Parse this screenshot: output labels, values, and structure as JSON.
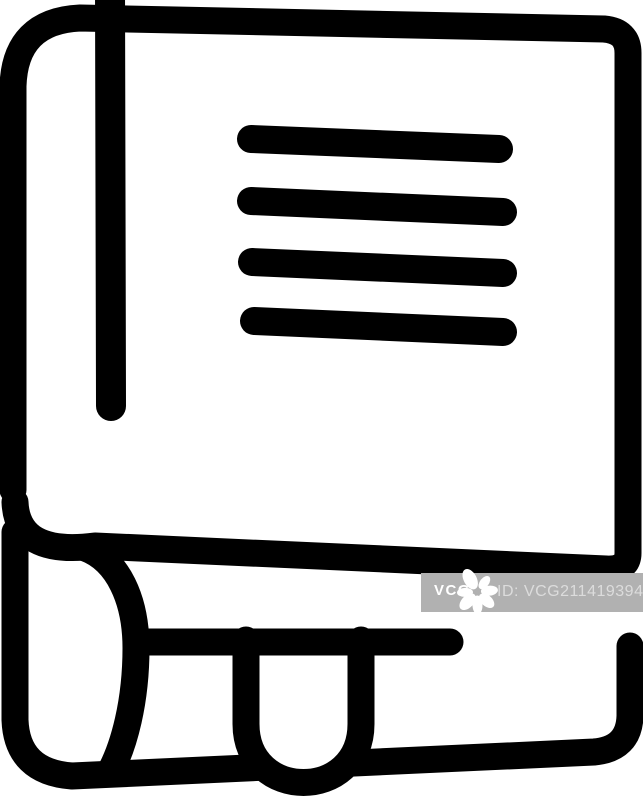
{
  "canvas": {
    "background_color": "#ffffff",
    "width": 643,
    "height": 800
  },
  "icon": {
    "name": "book-with-bookmark-line-icon",
    "description": "Black outline book: tilted cover, spine line, four text lines, rolled page with hanging bookmark",
    "color": "#000000"
  },
  "watermark": {
    "brand": "VCG",
    "id_label": "ID: VCG211419394340",
    "logo_icon": "vcg-flower-icon",
    "bar_color": "#b1b1b1",
    "brand_color": "#ffffff",
    "id_color": "rgba(255,255,255,0.55)"
  }
}
